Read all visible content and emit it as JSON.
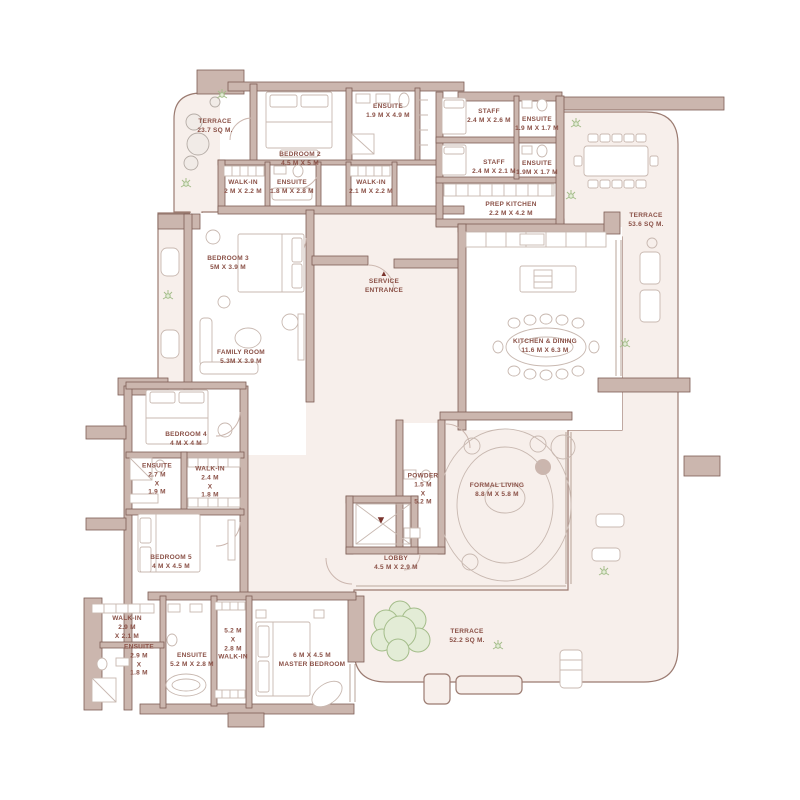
{
  "figure": {
    "type": "floor-plan"
  },
  "colors": {
    "wall_fill": "#cbb6ae",
    "wall_outline": "#7e5e55",
    "floor_tint": "#f7efeb",
    "label_text": "#8a5046",
    "entrance_accent": "#7a332c",
    "plant_green": "#a4bd8a"
  },
  "icons": {
    "service_entrance_arrow": "up-triangle-icon",
    "lobby_entrance_arrow": "down-triangle-icon"
  },
  "rooms": [
    {
      "name": "TERRACE",
      "dims": "23.7 SQ M."
    },
    {
      "name": "BEDROOM 2",
      "dims": "4.5 M X 5 M"
    },
    {
      "name": "ENSUITE",
      "dims": "1.9 M X 4.9 M"
    },
    {
      "name": "WALK-IN",
      "dims": "2 M X 2.2 M"
    },
    {
      "name": "ENSUITE",
      "dims": "1.8 M X 2.8 M"
    },
    {
      "name": "WALK-IN",
      "dims": "2.1 M X 2.2 M"
    },
    {
      "name": "STAFF",
      "dims": "2.4 M X 2.6 M"
    },
    {
      "name": "ENSUITE",
      "dims": "1.9 M X 1.7 M"
    },
    {
      "name": "STAFF",
      "dims": "2.4 M X 2.1 M"
    },
    {
      "name": "ENSUITE",
      "dims": "1.9M X 1.7 M"
    },
    {
      "name": "PREP KITCHEN",
      "dims": "2.2 M X 4.2 M"
    },
    {
      "name": "TERRACE",
      "dims": "53.6 SQ M."
    },
    {
      "name": "BEDROOM 3",
      "dims": "5M X 3.9 M"
    },
    {
      "name": "SERVICE\nENTRANCE",
      "arrow": "▲"
    },
    {
      "name": "KITCHEN & DINING",
      "dims": "11.6 M X 6.3 M"
    },
    {
      "name": "FAMILY ROOM",
      "dims": "5.3M X 3.9 M"
    },
    {
      "name": "BEDROOM 4",
      "dims": "4 M X 4 M"
    },
    {
      "name": "ENSUITE",
      "dims": "2.7 M\nX\n1.9 M"
    },
    {
      "name": "WALK-IN",
      "dims": "2.4 M\nX\n1.8 M"
    },
    {
      "name": "POWDER",
      "dims": "1.5 M\nX\n5.2 M"
    },
    {
      "name": "FORMAL LIVING",
      "dims": "8.8 M X 5.8 M"
    },
    {
      "name": "BEDROOM 5",
      "dims": "4 M X 4.5 M"
    },
    {
      "name": "LOBBY",
      "dims": "4.5 M X 2.9 M",
      "arrow": "▼"
    },
    {
      "name": "WALK-IN",
      "dims": "2.9 M\nX 2.1 M"
    },
    {
      "name": "ENSUITE",
      "dims": "2.9 M\nX\n1.8 M"
    },
    {
      "name": "ENSUITE",
      "dims": "5.2 M X 2.8 M"
    },
    {
      "name": "WALK-IN",
      "dims": "5.2 M\nX\n2.8 M"
    },
    {
      "name": "MASTER BEDROOM",
      "dims": "6 M X 4.5 M"
    },
    {
      "name": "TERRACE",
      "dims": "52.2 SQ M."
    }
  ]
}
